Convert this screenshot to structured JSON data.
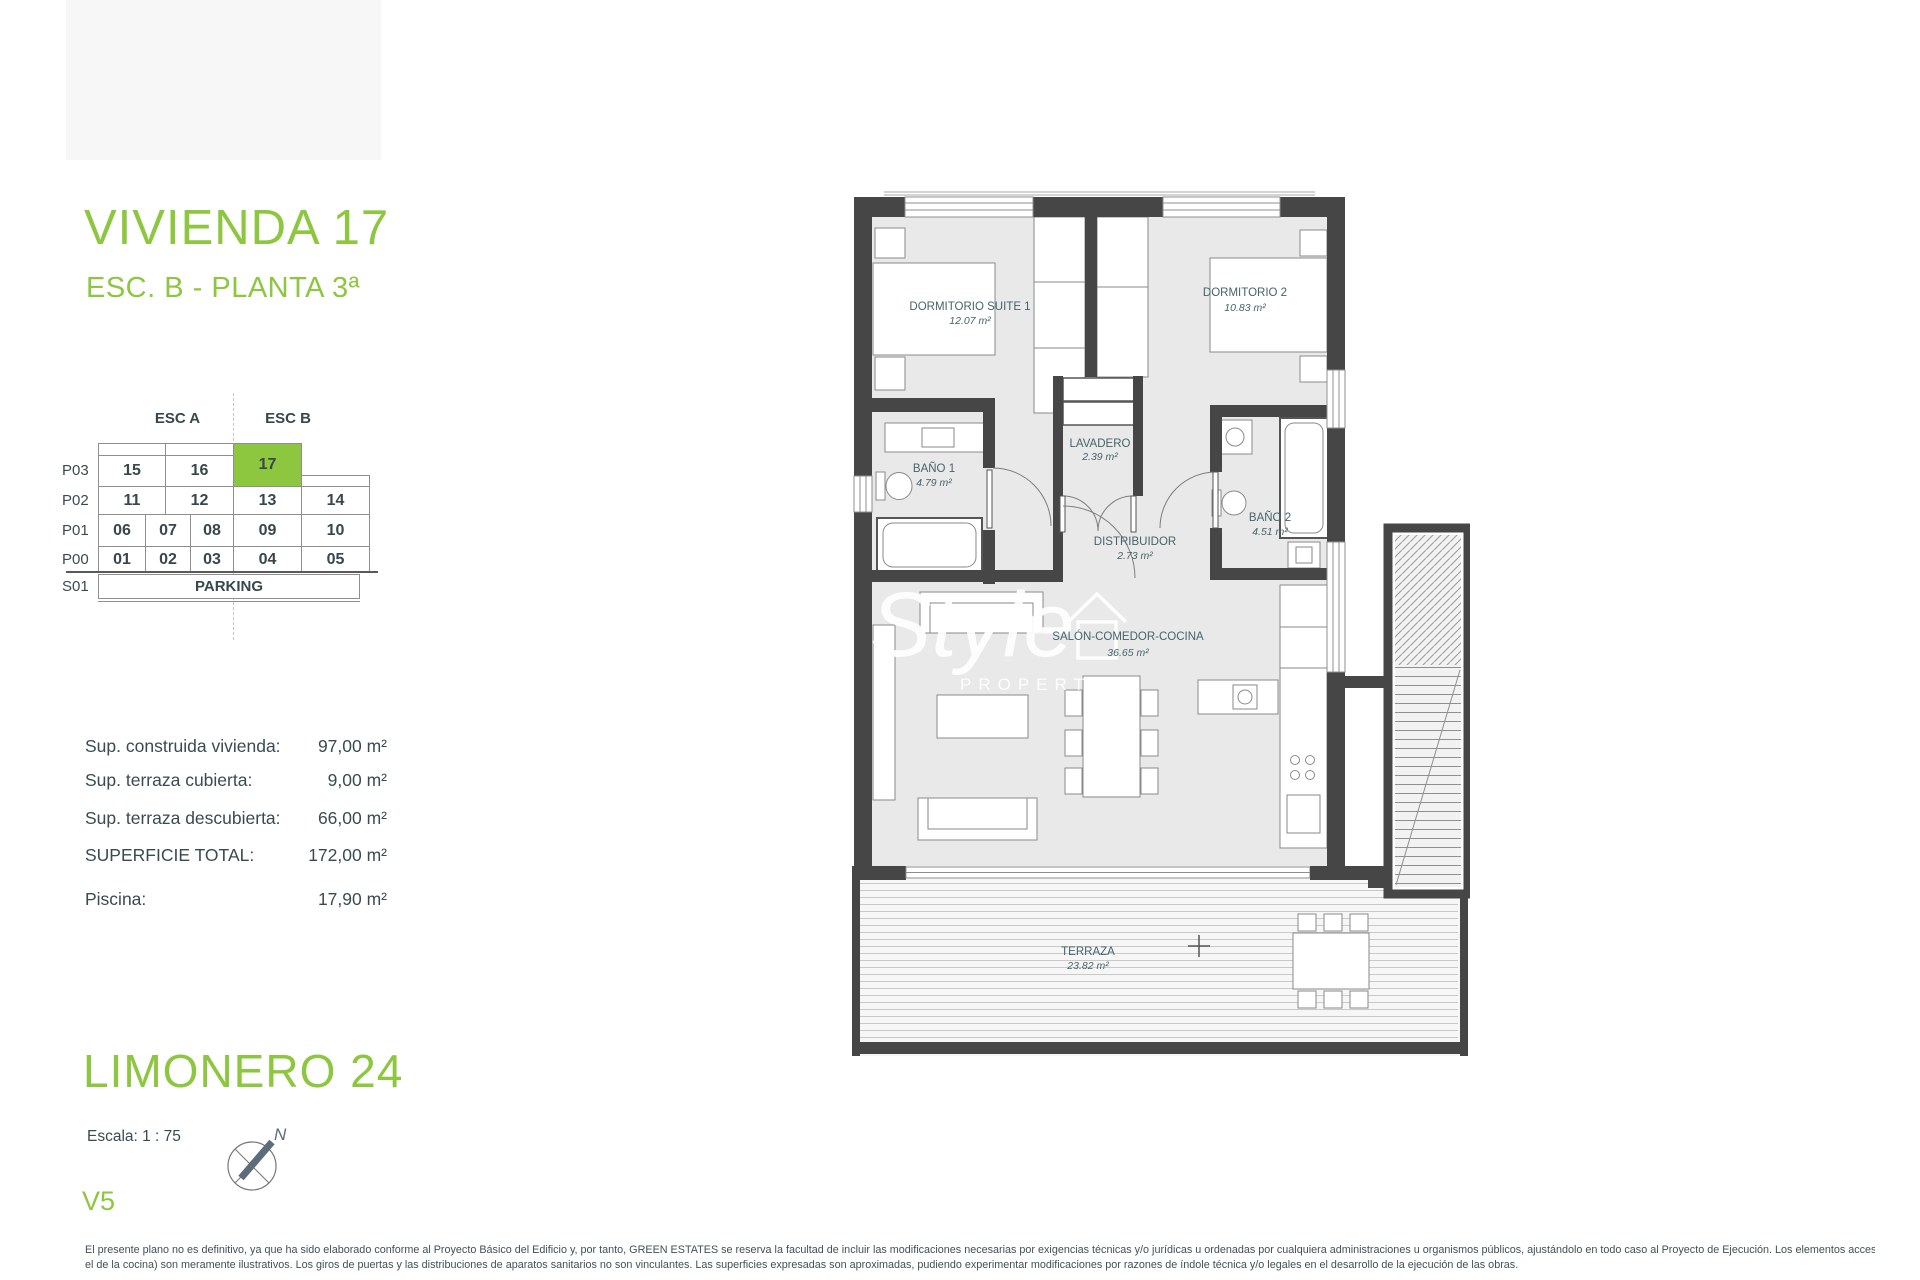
{
  "accent_green": "#8dc63f",
  "header": {
    "title": "VIVIENDA 17",
    "subtitle": "ESC. B - PLANTA 3ª"
  },
  "matrix": {
    "col_headers": [
      "ESC A",
      "ESC B"
    ],
    "highlighted_unit": "17",
    "rows": [
      {
        "label": "P03",
        "cells": [
          "15",
          "16",
          "17"
        ]
      },
      {
        "label": "P02",
        "cells": [
          "11",
          "12",
          "13",
          "14"
        ]
      },
      {
        "label": "P01",
        "cells": [
          "06",
          "07",
          "08",
          "09",
          "10"
        ]
      },
      {
        "label": "P00",
        "cells": [
          "01",
          "02",
          "03",
          "04",
          "05"
        ]
      },
      {
        "label": "S01",
        "cells": [
          "PARKING"
        ]
      }
    ]
  },
  "surfaces": {
    "rows": [
      {
        "label": "Sup. construida vivienda:",
        "value": "97,00 m²"
      },
      {
        "label": "Sup. terraza cubierta:",
        "value": "9,00 m²"
      },
      {
        "label": "Sup. terraza descubierta:",
        "value": "66,00 m²"
      },
      {
        "label": "SUPERFICIE TOTAL:",
        "value": "172,00 m²"
      },
      {
        "label": "Piscina:",
        "value": "17,90 m²"
      }
    ]
  },
  "plan": {
    "rooms": [
      {
        "name": "DORMITORIO SUITE 1",
        "area": "12.07 m²"
      },
      {
        "name": "DORMITORIO 2",
        "area": "10.83 m²"
      },
      {
        "name": "BAÑO 1",
        "area": "4.79 m²"
      },
      {
        "name": "LAVADERO",
        "area": "2.39 m²"
      },
      {
        "name": "BAÑO 2",
        "area": "4.51 m²"
      },
      {
        "name": "DISTRIBUIDOR",
        "area": "2.73 m²"
      },
      {
        "name": "SALÓN-COMEDOR-COCINA",
        "area": "36.65 m²"
      },
      {
        "name": "TERRAZA",
        "area": "23.82 m²"
      }
    ],
    "watermark": {
      "line1": "Style",
      "line2": "PROPERTIES"
    }
  },
  "footer": {
    "project": "LIMONERO 24",
    "scale": "Escala: 1 : 75",
    "compass_label": "N",
    "version": "V5",
    "disclaimer_line1": "El presente plano no es definitivo, ya que ha sido elaborado conforme al Proyecto Básico del Edificio y, por tanto, GREEN ESTATES se reserva la facultad de incluir las modificaciones necesarias por exigencias técnicas y/o jurídicas u ordenadas por cualquiera administraciones u organismos públicos, ajustándolo en todo caso al Proyecto de Ejecución. Los elementos accesorios (por ejemplo, el mobiliario, incluido",
    "disclaimer_line2": "el de la cocina) son meramente ilustrativos. Los giros de puertas y las distribuciones de aparatos sanitarios no son vinculantes. Las superficies expresadas son aproximadas, pudiendo experimentar modificaciones por razones de índole técnica y/o legales en el desarrollo de la ejecución de las obras."
  }
}
